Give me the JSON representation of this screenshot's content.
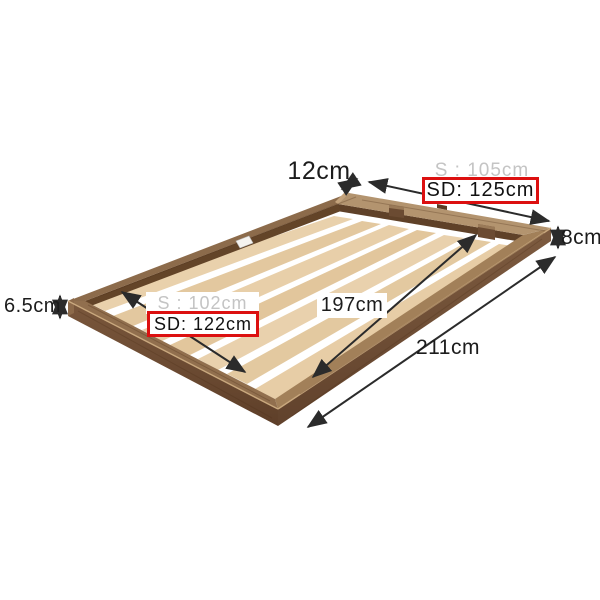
{
  "diagram": {
    "subject": "floor-type wooden slatted bed frame, perspective view with dimension annotations",
    "labels": {
      "rail_width": "12cm",
      "top_width_single": "S : 105cm",
      "top_width_semidouble": "SD: 125cm",
      "frame_height_right": "8cm",
      "frame_height_left": "6.5cm",
      "inner_width_single": "S : 102cm",
      "inner_width_semidouble": "SD: 122cm",
      "inner_length": "197cm",
      "outer_length": "211cm"
    },
    "highlight": {
      "style": "red outlined box",
      "applies_to": [
        "top_width_semidouble",
        "inner_width_semidouble"
      ],
      "border_color": "#dc1010"
    },
    "colors": {
      "background": "#ffffff",
      "dimension_text": "#1c1c1c",
      "muted_size_text": "#c4c4c4",
      "arrow": "#2b2b2b",
      "frame_wood_top": "#95734f",
      "frame_wood_side": "#6e4d34",
      "slat_wood": "#e7cea8",
      "gap": "#ffffff"
    },
    "slat_count": 7
  }
}
